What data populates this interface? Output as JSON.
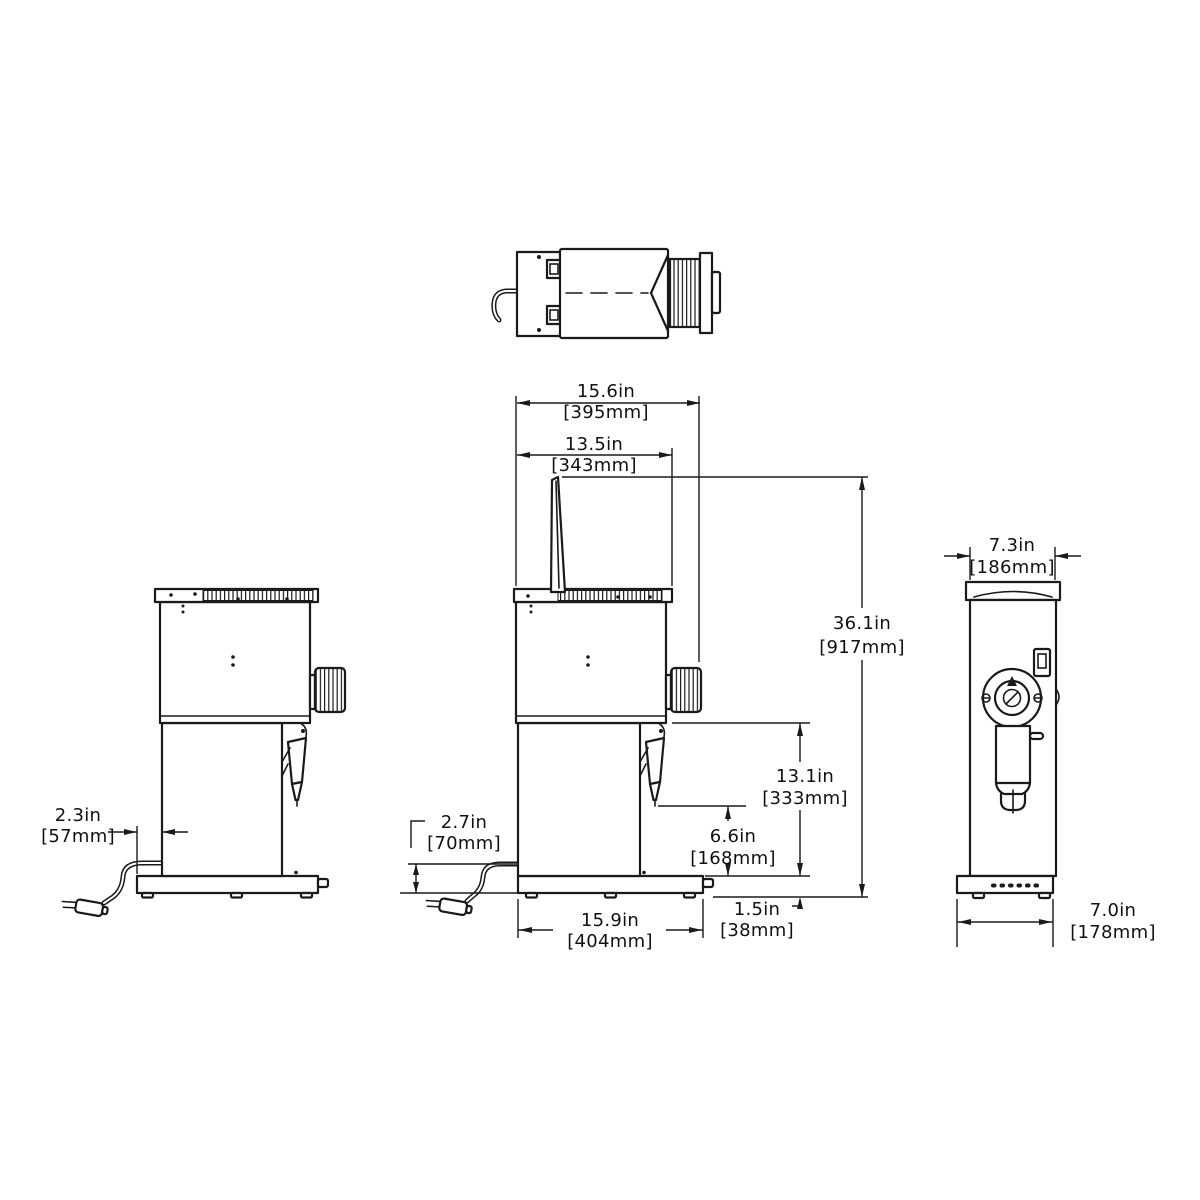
{
  "drawing": {
    "background": "#ffffff",
    "line_color": "#1a1a1a"
  },
  "dims": {
    "overall_depth": {
      "in": "15.6in",
      "mm": "[395mm]"
    },
    "body_depth": {
      "in": "13.5in",
      "mm": "[343mm]"
    },
    "overall_height": {
      "in": "36.1in",
      "mm": "[917mm]"
    },
    "chamber_height": {
      "in": "13.1in",
      "mm": "[333mm]"
    },
    "spout_clearance": {
      "in": "6.6in",
      "mm": "[168mm]"
    },
    "cord_height": {
      "in": "2.7in",
      "mm": "[70mm]"
    },
    "rear_overhang": {
      "in": "2.3in",
      "mm": "[57mm]"
    },
    "base_depth": {
      "in": "15.9in",
      "mm": "[404mm]"
    },
    "base_height": {
      "in": "1.5in",
      "mm": "[38mm]"
    },
    "overall_width": {
      "in": "7.3in",
      "mm": "[186mm]"
    },
    "base_width": {
      "in": "7.0in",
      "mm": "[178mm]"
    }
  }
}
